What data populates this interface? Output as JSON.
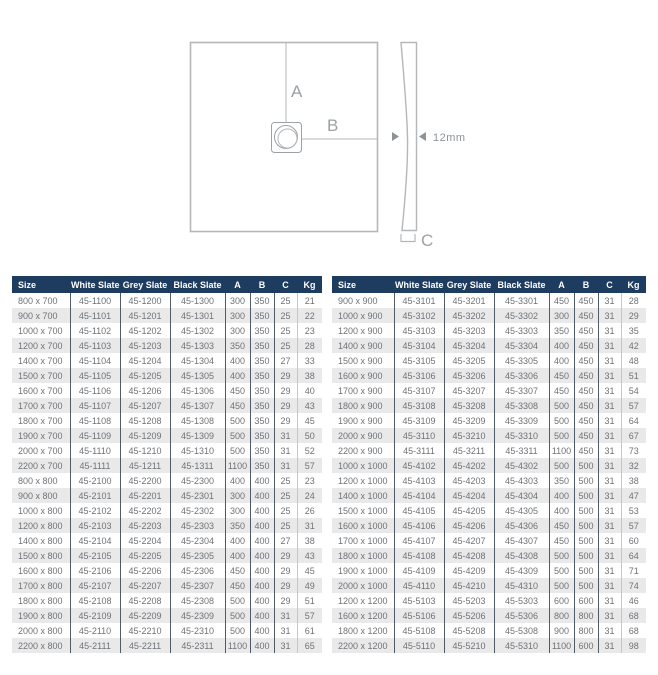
{
  "diagram": {
    "label_a": "A",
    "label_b": "B",
    "label_c": "C",
    "thickness_label": "12mm"
  },
  "colors": {
    "header_bg": "#1d3c60",
    "row_stripe": "#e9e9ea",
    "cell_text": "#6e7276",
    "column_divider": "#4f5b66",
    "diagram_stroke": "#b3b7ba",
    "diagram_text": "#9ba1a5"
  },
  "tables": [
    {
      "name": "left",
      "columns": [
        "Size",
        "White Slate",
        "Grey Slate",
        "Black Slate",
        "A",
        "B",
        "C",
        "Kg"
      ],
      "rows": [
        [
          "800 x 700",
          "45-1100",
          "45-1200",
          "45-1300",
          "300",
          "350",
          "25",
          "21"
        ],
        [
          "900 x 700",
          "45-1101",
          "45-1201",
          "45-1301",
          "300",
          "350",
          "25",
          "22"
        ],
        [
          "1000 x 700",
          "45-1102",
          "45-1202",
          "45-1302",
          "300",
          "350",
          "25",
          "23"
        ],
        [
          "1200 x 700",
          "45-1103",
          "45-1203",
          "45-1303",
          "350",
          "350",
          "25",
          "28"
        ],
        [
          "1400 x 700",
          "45-1104",
          "45-1204",
          "45-1304",
          "400",
          "350",
          "27",
          "33"
        ],
        [
          "1500 x 700",
          "45-1105",
          "45-1205",
          "45-1305",
          "400",
          "350",
          "29",
          "38"
        ],
        [
          "1600 x 700",
          "45-1106",
          "45-1206",
          "45-1306",
          "450",
          "350",
          "29",
          "40"
        ],
        [
          "1700 x 700",
          "45-1107",
          "45-1207",
          "45-1307",
          "450",
          "350",
          "29",
          "43"
        ],
        [
          "1800 x 700",
          "45-1108",
          "45-1208",
          "45-1308",
          "500",
          "350",
          "29",
          "45"
        ],
        [
          "1900 x 700",
          "45-1109",
          "45-1209",
          "45-1309",
          "500",
          "350",
          "31",
          "50"
        ],
        [
          "2000 x 700",
          "45-1110",
          "45-1210",
          "45-1310",
          "500",
          "350",
          "31",
          "52"
        ],
        [
          "2200 x 700",
          "45-1111",
          "45-1211",
          "45-1311",
          "1100",
          "350",
          "31",
          "57"
        ],
        [
          "800 x 800",
          "45-2100",
          "45-2200",
          "45-2300",
          "400",
          "400",
          "25",
          "23"
        ],
        [
          "900 x 800",
          "45-2101",
          "45-2201",
          "45-2301",
          "300",
          "400",
          "25",
          "24"
        ],
        [
          "1000 x 800",
          "45-2102",
          "45-2202",
          "45-2302",
          "300",
          "400",
          "25",
          "26"
        ],
        [
          "1200 x 800",
          "45-2103",
          "45-2203",
          "45-2303",
          "350",
          "400",
          "25",
          "31"
        ],
        [
          "1400 x 800",
          "45-2104",
          "45-2204",
          "45-2304",
          "400",
          "400",
          "27",
          "38"
        ],
        [
          "1500 x 800",
          "45-2105",
          "45-2205",
          "45-2305",
          "400",
          "400",
          "29",
          "43"
        ],
        [
          "1600 x 800",
          "45-2106",
          "45-2206",
          "45-2306",
          "450",
          "400",
          "29",
          "45"
        ],
        [
          "1700 x 800",
          "45-2107",
          "45-2207",
          "45-2307",
          "450",
          "400",
          "29",
          "49"
        ],
        [
          "1800 x 800",
          "45-2108",
          "45-2208",
          "45-2308",
          "500",
          "400",
          "29",
          "51"
        ],
        [
          "1900 x 800",
          "45-2109",
          "45-2209",
          "45-2309",
          "500",
          "400",
          "31",
          "57"
        ],
        [
          "2000 x 800",
          "45-2110",
          "45-2210",
          "45-2310",
          "500",
          "400",
          "31",
          "61"
        ],
        [
          "2200 x 800",
          "45-2111",
          "45-2211",
          "45-2311",
          "1100",
          "400",
          "31",
          "65"
        ]
      ]
    },
    {
      "name": "right",
      "columns": [
        "Size",
        "White Slate",
        "Grey Slate",
        "Black Slate",
        "A",
        "B",
        "C",
        "Kg"
      ],
      "rows": [
        [
          "900 x 900",
          "45-3101",
          "45-3201",
          "45-3301",
          "450",
          "450",
          "31",
          "28"
        ],
        [
          "1000 x 900",
          "45-3102",
          "45-3202",
          "45-3302",
          "300",
          "450",
          "31",
          "29"
        ],
        [
          "1200 x 900",
          "45-3103",
          "45-3203",
          "45-3303",
          "350",
          "450",
          "31",
          "35"
        ],
        [
          "1400 x 900",
          "45-3104",
          "45-3204",
          "45-3304",
          "400",
          "450",
          "31",
          "42"
        ],
        [
          "1500 x 900",
          "45-3105",
          "45-3205",
          "45-3305",
          "400",
          "450",
          "31",
          "48"
        ],
        [
          "1600 x 900",
          "45-3106",
          "45-3206",
          "45-3306",
          "450",
          "450",
          "31",
          "51"
        ],
        [
          "1700 x 900",
          "45-3107",
          "45-3207",
          "45-3307",
          "450",
          "450",
          "31",
          "54"
        ],
        [
          "1800 x 900",
          "45-3108",
          "45-3208",
          "45-3308",
          "500",
          "450",
          "31",
          "57"
        ],
        [
          "1900 x 900",
          "45-3109",
          "45-3209",
          "45-3309",
          "500",
          "450",
          "31",
          "64"
        ],
        [
          "2000 x 900",
          "45-3110",
          "45-3210",
          "45-3310",
          "500",
          "450",
          "31",
          "67"
        ],
        [
          "2200 x 900",
          "45-3111",
          "45-3211",
          "45-3311",
          "1100",
          "450",
          "31",
          "73"
        ],
        [
          "1000 x 1000",
          "45-4102",
          "45-4202",
          "45-4302",
          "500",
          "500",
          "31",
          "32"
        ],
        [
          "1200 x 1000",
          "45-4103",
          "45-4203",
          "45-4303",
          "350",
          "500",
          "31",
          "38"
        ],
        [
          "1400 x 1000",
          "45-4104",
          "45-4204",
          "45-4304",
          "400",
          "500",
          "31",
          "47"
        ],
        [
          "1500 x 1000",
          "45-4105",
          "45-4205",
          "45-4305",
          "400",
          "500",
          "31",
          "53"
        ],
        [
          "1600 x 1000",
          "45-4106",
          "45-4206",
          "45-4306",
          "450",
          "500",
          "31",
          "57"
        ],
        [
          "1700 x 1000",
          "45-4107",
          "45-4207",
          "45-4307",
          "450",
          "500",
          "31",
          "60"
        ],
        [
          "1800 x 1000",
          "45-4108",
          "45-4208",
          "45-4308",
          "500",
          "500",
          "31",
          "64"
        ],
        [
          "1900 x 1000",
          "45-4109",
          "45-4209",
          "45-4309",
          "500",
          "500",
          "31",
          "71"
        ],
        [
          "2000 x 1000",
          "45-4110",
          "45-4210",
          "45-4310",
          "500",
          "500",
          "31",
          "74"
        ],
        [
          "1200 x 1200",
          "45-5103",
          "45-5203",
          "45-5303",
          "600",
          "600",
          "31",
          "46"
        ],
        [
          "1600 x 1200",
          "45-5106",
          "45-5206",
          "45-5306",
          "800",
          "800",
          "31",
          "68"
        ],
        [
          "1800 x 1200",
          "45-5108",
          "45-5208",
          "45-5308",
          "900",
          "800",
          "31",
          "68"
        ],
        [
          "2200 x 1200",
          "45-5110",
          "45-5210",
          "45-5310",
          "1100",
          "600",
          "31",
          "98"
        ]
      ]
    }
  ]
}
